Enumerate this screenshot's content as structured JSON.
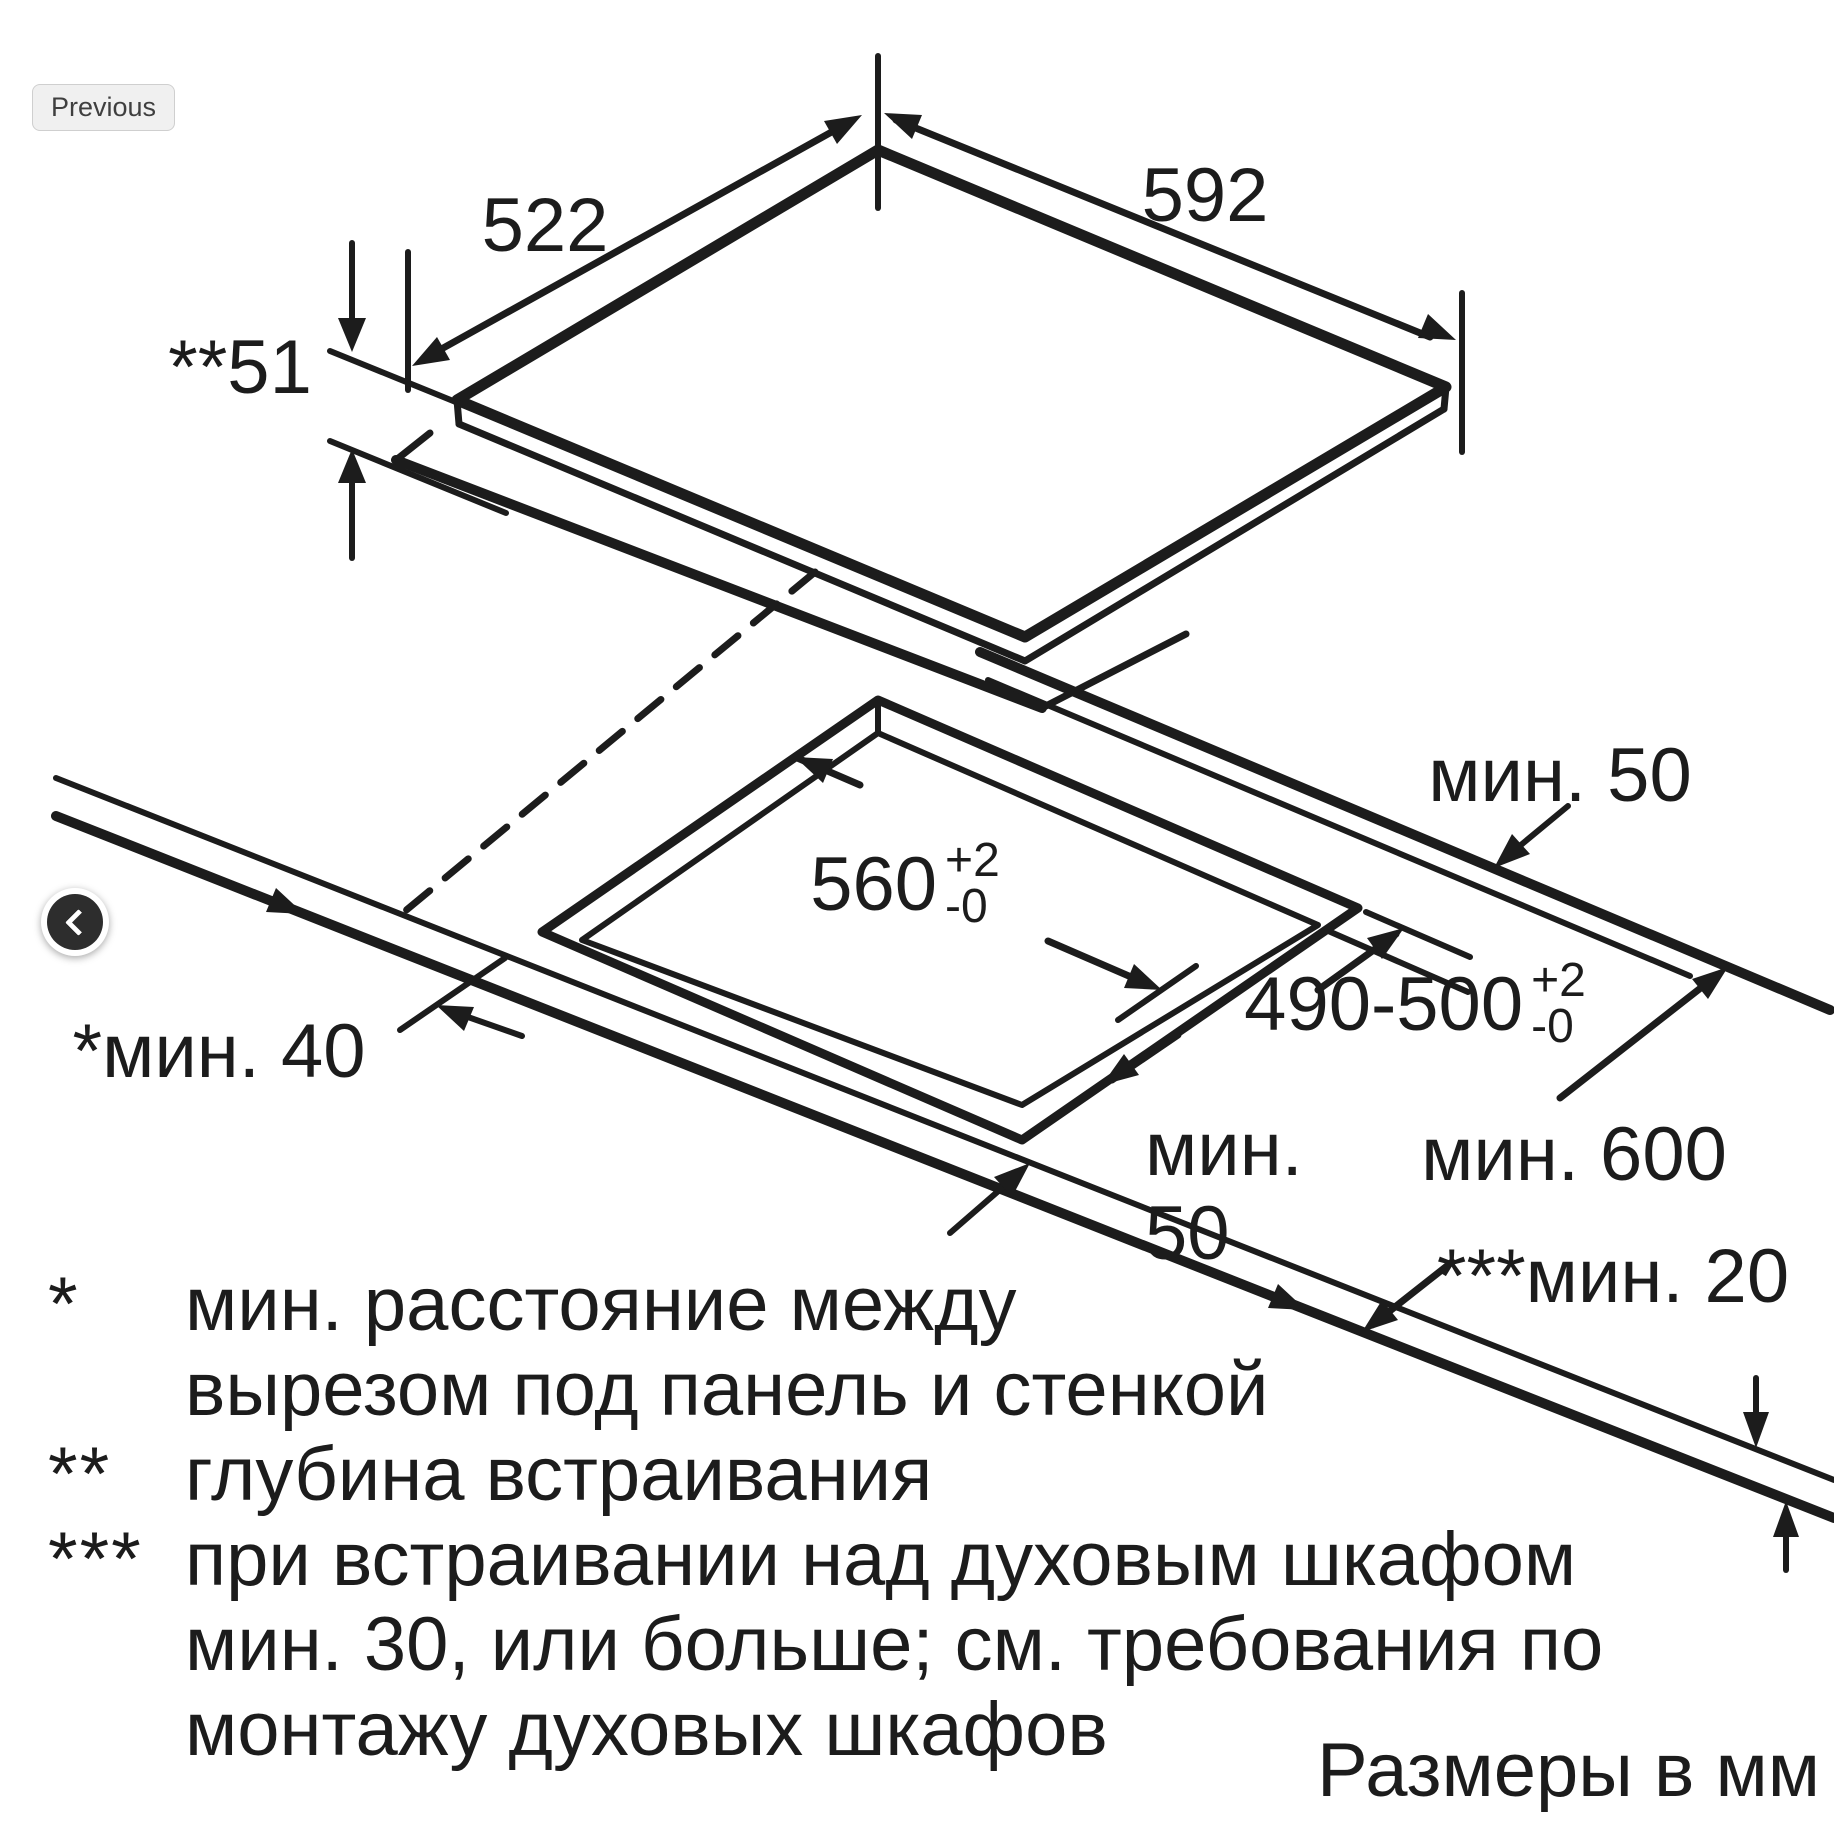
{
  "page": {
    "ink_color": "#1c1c1c",
    "background_color": "#ffffff",
    "prev_button_bg": "#f0f0f0",
    "carousel_button_bg": "#2d2d2d"
  },
  "controls": {
    "previous_button_label": "Previous"
  },
  "diagram": {
    "dimensions": {
      "appliance_depth": "522",
      "appliance_width": "592",
      "build_in_height": "**51",
      "min_back_clearance": "мин. 50",
      "cutout_width": "560",
      "cutout_width_tol_plus": "+2",
      "cutout_width_tol_minus": "-0",
      "cutout_depth": "490-500",
      "cutout_depth_tol_plus": "+2",
      "cutout_depth_tol_minus": "-0",
      "min_side_clearance": "*мин. 40",
      "min_front_clearance_line1": "мин.",
      "min_front_clearance_line2": "50",
      "min_worktop_depth": "мин. 600",
      "min_bottom_clearance": "***мин. 20"
    },
    "footnotes": [
      {
        "marker": "*",
        "text": "мин. расстояние между"
      },
      {
        "marker": "",
        "text": "вырезом под панель и стенкой"
      },
      {
        "marker": "**",
        "text": "глубина встраивания"
      },
      {
        "marker": "***",
        "text": "при встраивании над духовым шкафом"
      },
      {
        "marker": "",
        "text": "мин. 30, или больше; см. требования по"
      },
      {
        "marker": "",
        "text": "монтажу духовых шкафов"
      }
    ],
    "units_note": "Размеры в мм"
  }
}
